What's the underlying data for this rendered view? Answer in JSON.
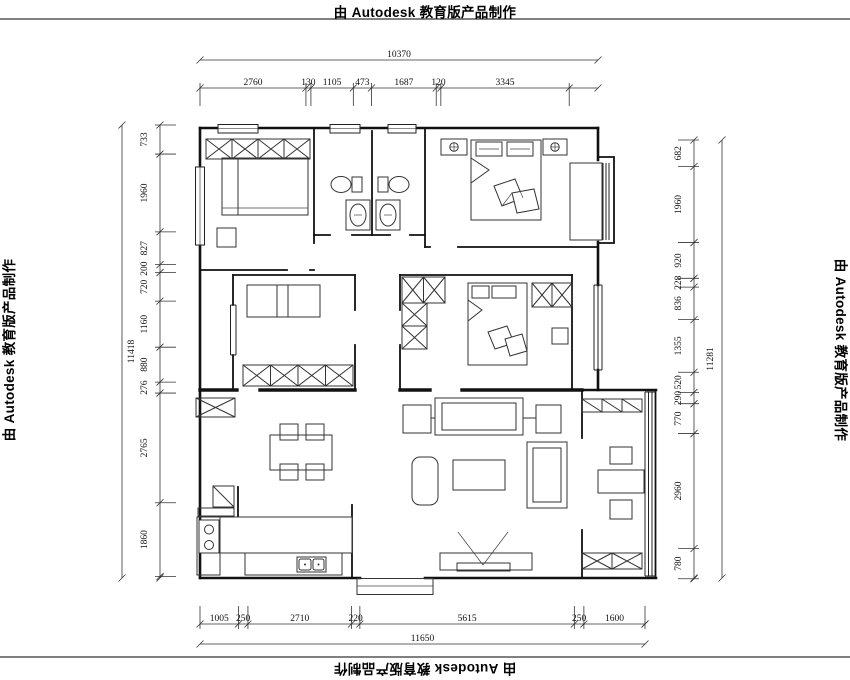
{
  "watermarks": {
    "top": "由 Autodesk 教育版产品制作",
    "bottom": "由 Autodesk 教育版产品制作",
    "left": "由 Autodesk 教育版产品制作",
    "right": "由 Autodesk 教育版产品制作"
  },
  "drawing": {
    "type": "floor-plan",
    "units": "mm",
    "dimensions": {
      "top": {
        "total": "10370",
        "segments": [
          "2760",
          "130",
          "1105",
          "473",
          "1687",
          "120",
          "3345"
        ]
      },
      "bottom": {
        "total": "11650",
        "segments": [
          "1005",
          "250",
          "2710",
          "220",
          "5615",
          "250",
          "1600"
        ]
      },
      "left": {
        "total": "11418",
        "segments": [
          "733",
          "1960",
          "827",
          "200",
          "720",
          "1160",
          "880",
          "276",
          "2765",
          "1860"
        ]
      },
      "right": {
        "total": "11281",
        "segments": [
          "682",
          "1960",
          "920",
          "228",
          "836",
          "1355",
          "520",
          "290",
          "770",
          "2960",
          "780"
        ]
      }
    },
    "colors": {
      "line": "#111111",
      "dimension": "#333333",
      "background": "#ffffff"
    }
  }
}
